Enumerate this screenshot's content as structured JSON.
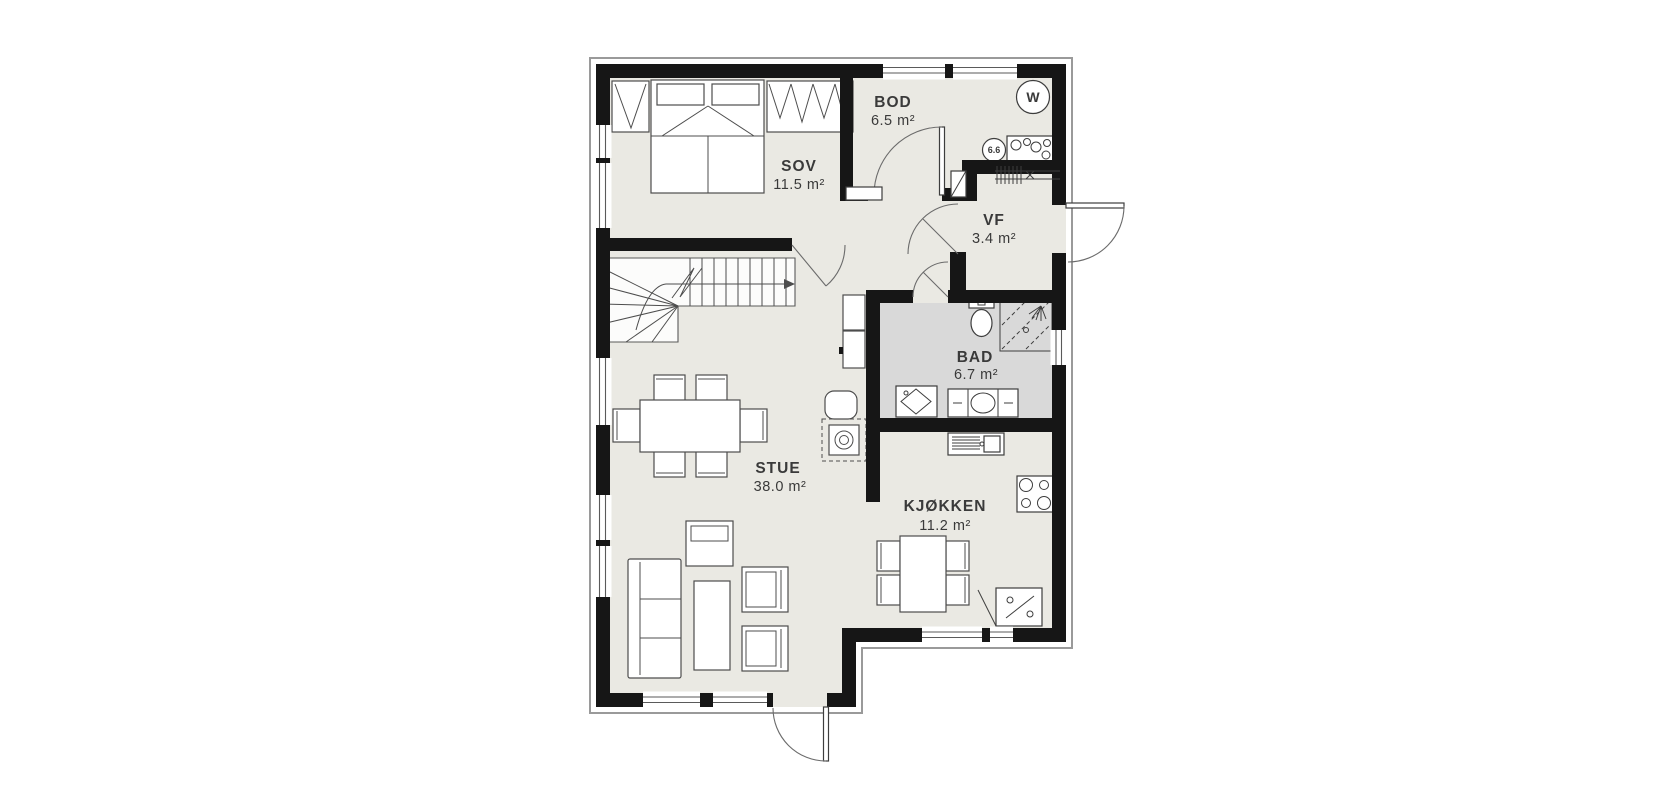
{
  "figure": {
    "type": "floor-plan",
    "language": "Norwegian",
    "units": "m²"
  },
  "rooms": [
    {
      "id": "sov",
      "name": "SOV",
      "area": "11.5 m²"
    },
    {
      "id": "bod",
      "name": "BOD",
      "area": "6.5 m²"
    },
    {
      "id": "vf",
      "name": "VF",
      "area": "3.4 m²"
    },
    {
      "id": "bad",
      "name": "BAD",
      "area": "6.7 m²"
    },
    {
      "id": "stue",
      "name": "STUE",
      "area": "38.0 m²"
    },
    {
      "id": "kjokken",
      "name": "KJØKKEN",
      "area": "11.2 m²"
    }
  ],
  "appliances": {
    "water_heater_label": "W",
    "tank_label": "6.6"
  },
  "colors": {
    "wall": "#161616",
    "floor": "#eae9e3",
    "bathroom_floor": "#d9d9d9",
    "cladding_outline": "#9a9a9a",
    "background": "#ffffff",
    "furniture_stroke": "#4d4d4d",
    "label_text": "#3a3a3a"
  }
}
